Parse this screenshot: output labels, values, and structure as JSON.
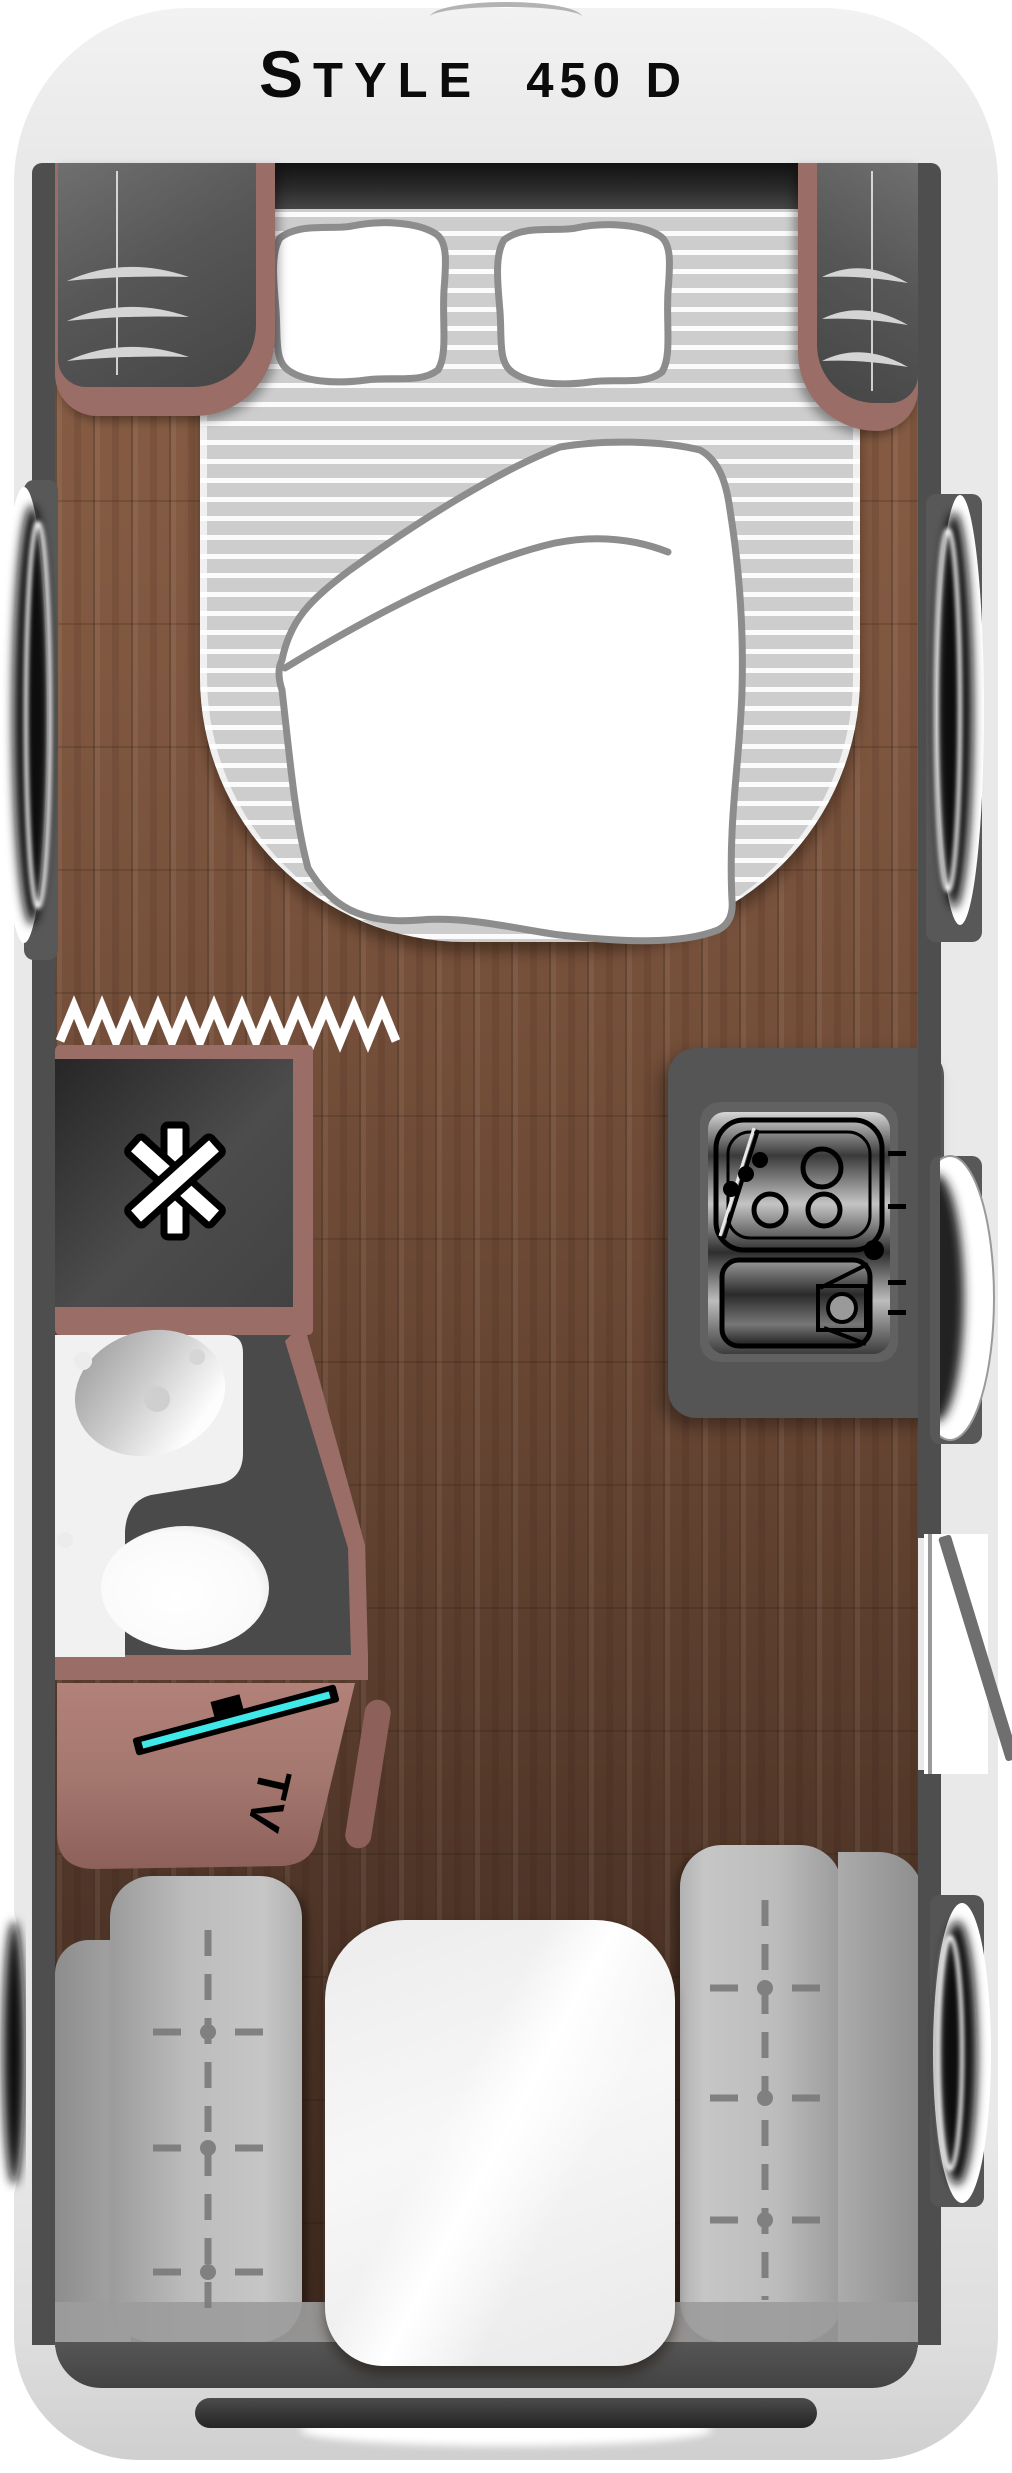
{
  "header": {
    "brand_initial": "S",
    "brand_rest": "TYLE",
    "model": "450 D"
  },
  "labels": {
    "tv": "TV"
  },
  "icons": {
    "shower": "asterisk-6-spoke-icon",
    "room_divider": "zigzag-line-icon",
    "tv_screen": "angled-flatscreen-bar-icon",
    "hob": "three-burner-hob-icon",
    "sink": "basin-with-faucet-icon",
    "bench_stitch": "dashed-cross-markers"
  },
  "colors": {
    "page_background": "#ffffff",
    "body_shell": "#e9e9e9",
    "interior_wall": "#4e4e4e",
    "front_band": "#1c1c1c",
    "wood_floor": "#6f4b37",
    "furniture_trim": "#9a6d67",
    "tv_cabinet": "#a4786f",
    "tv_screen_accent": "#3fe9e9",
    "kitchen_counter": "#555555",
    "mattress_stripe_gray": "#cdcdcd",
    "bench_gray": "#bcbcbc",
    "table_white": "#f5f5f5"
  }
}
